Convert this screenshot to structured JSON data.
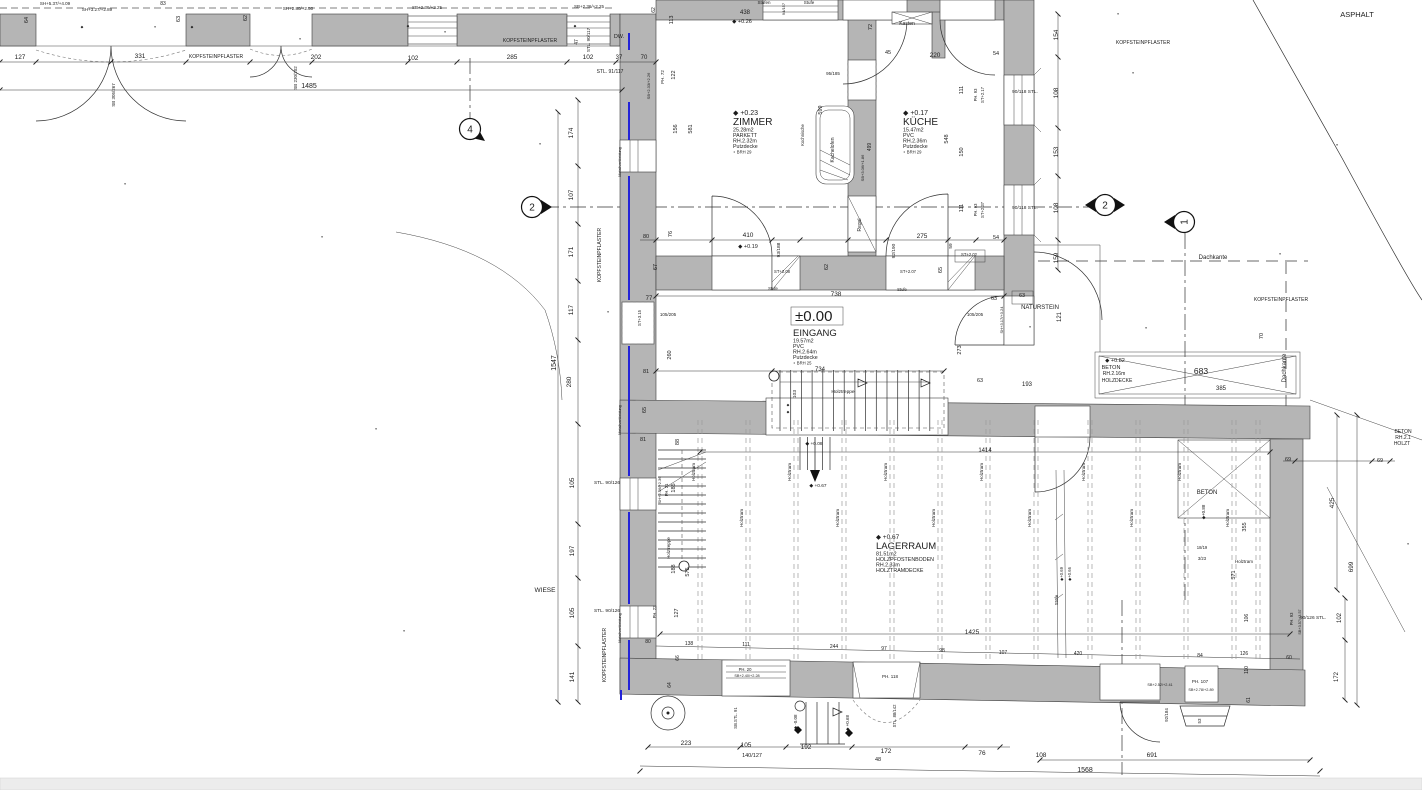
{
  "colors": {
    "wall_fill": "#b5b5b5",
    "line": "#2e2e2e",
    "cladding_blue": "#2323d8",
    "background": "#ffffff"
  },
  "rooms": {
    "zimmer": {
      "level": "◆ +0.23",
      "title": "ZIMMER",
      "l1": "25.28m2",
      "l2": "PARKETT",
      "l3": "RH.2.32m",
      "l4": "Putzdecke",
      "l5": "∘ BRH 29"
    },
    "kueche": {
      "level": "◆ +0.17",
      "title": "KÜCHE",
      "l1": "15.47m2",
      "l2": "PVC",
      "l3": "RH.2.36m",
      "l4": "Putzdecke",
      "l5": "∘ BRH 29"
    },
    "eingang": {
      "level": "±0.00",
      "title": "EINGANG",
      "l1": "19.57m2",
      "l2": "PVC",
      "l3": "RH.2.64m",
      "l4": "Putzdecke",
      "l5": "∘ BRH 25"
    },
    "lagerraum": {
      "level": "◆ +0.67",
      "title": "LAGERRAUM",
      "l1": "81.51m2",
      "l2": "HOLZPFOSTENBODEN",
      "l3": "RH.2.33m",
      "l4": "HOLZTRAMDECKE"
    }
  },
  "beams": {
    "label": "Holztram",
    "xs": [
      700,
      748,
      796,
      844,
      892,
      940,
      988,
      1036,
      1090,
      1138,
      1186,
      1234,
      1258
    ]
  },
  "markers": [
    {
      "n": "4",
      "x": 470,
      "y": 129,
      "rot": 0,
      "tri": "br"
    },
    {
      "n": "2",
      "x": 532,
      "y": 207,
      "rot": 0,
      "tri": "r"
    },
    {
      "n": "2",
      "x": 1105,
      "y": 205,
      "rot": 0,
      "tri": "lr"
    },
    {
      "n": "1",
      "x": 1184,
      "y": 222,
      "rot": -90,
      "tri": "l"
    }
  ],
  "labels": [
    [
      "ASPHALT",
      1357,
      17,
      0,
      7.5
    ],
    [
      "KOPFSTEINPFLASTER",
      1143,
      44,
      0,
      5
    ],
    [
      "KOPFSTEINPFLASTER",
      216,
      58,
      0,
      5
    ],
    [
      "KOPFSTEINPFLASTER",
      530,
      42,
      0,
      5
    ],
    [
      "KOPFSTEINPFLASTER",
      1281,
      301,
      0,
      5
    ],
    [
      "KOPFSTEINPFLASTER",
      601,
      255,
      -90,
      5
    ],
    [
      "KOPFSTEINPFLASTER",
      606,
      655,
      -90,
      5
    ],
    [
      "WIESE",
      545,
      592,
      0,
      6.5
    ],
    [
      "NATURSTEIN",
      1040,
      309,
      0,
      6
    ],
    [
      "Dachkante",
      1213,
      259,
      0,
      6
    ],
    [
      "Dachkante",
      1286,
      368,
      -90,
      6
    ],
    [
      "SH+5.37/+4.09",
      55,
      5,
      0,
      4.5
    ],
    [
      "83",
      163,
      5,
      0,
      5
    ],
    [
      "SH+3.27/+2.89",
      97,
      11,
      0,
      4.5
    ],
    [
      "SH+2.80/+2.50",
      298,
      10,
      0,
      4.5
    ],
    [
      "SB+2.36/+2.25",
      427,
      9,
      0,
      4.5
    ],
    [
      "SB+2.36/+2.25",
      589,
      8,
      0,
      4.5
    ],
    [
      "64",
      28,
      20,
      -90,
      5.5
    ],
    [
      "63",
      180,
      19,
      -90,
      5.5
    ],
    [
      "62",
      247,
      18,
      -90,
      5.5
    ],
    [
      "127",
      20,
      59,
      0,
      6.5
    ],
    [
      "331",
      140,
      58,
      0,
      6.5
    ],
    [
      "202",
      316,
      59,
      0,
      6.5
    ],
    [
      "102",
      413,
      60,
      0,
      6.5
    ],
    [
      "285",
      512,
      59,
      0,
      6.5
    ],
    [
      "102",
      588,
      59,
      0,
      6.5
    ],
    [
      "37",
      619,
      59,
      0,
      6
    ],
    [
      "70",
      644,
      59,
      0,
      6
    ],
    [
      "1485",
      309,
      88,
      0,
      7
    ],
    [
      "SB 305/267",
      115,
      95,
      -90,
      4.5
    ],
    [
      "SB 230/202",
      297,
      78,
      -90,
      4.5
    ],
    [
      "DW.",
      619,
      38,
      0,
      5.5
    ],
    [
      "STL. 90/117",
      590,
      40,
      -90,
      4.5
    ],
    [
      "47",
      578,
      42,
      -90,
      5
    ],
    [
      "STL. 91/117",
      610,
      73,
      0,
      5
    ],
    [
      "113",
      673,
      20,
      -90,
      5.5
    ],
    [
      "122",
      675,
      75,
      -90,
      5.5
    ],
    [
      "62",
      655,
      10,
      -90,
      5
    ],
    [
      "PH. 72",
      664,
      77,
      -90,
      4.5
    ],
    [
      "SB+2.33/+2.26",
      650,
      86,
      -90,
      4
    ],
    [
      "156",
      677,
      129,
      -90,
      5.5
    ],
    [
      "581",
      692,
      129,
      -90,
      5.5
    ],
    [
      "174",
      573,
      133,
      -90,
      6.5
    ],
    [
      "107",
      573,
      195,
      -90,
      6.5
    ],
    [
      "171",
      573,
      252,
      -90,
      6.5
    ],
    [
      "117",
      573,
      310,
      -90,
      6.5
    ],
    [
      "280",
      571,
      382,
      -90,
      6.5
    ],
    [
      "1547",
      556,
      363,
      -90,
      7
    ],
    [
      "105",
      574,
      483,
      -90,
      6.5
    ],
    [
      "197",
      574,
      551,
      -90,
      6.5
    ],
    [
      "105",
      574,
      613,
      -90,
      6.5
    ],
    [
      "141",
      574,
      677,
      -90,
      6.5
    ],
    [
      "Metallverkleidung",
      621,
      162,
      -90,
      3.8
    ],
    [
      "Metallverkleidung",
      621,
      420,
      -90,
      3.8
    ],
    [
      "Metallverkleidung",
      621,
      628,
      -90,
      3.8
    ],
    [
      "STL. 90/126",
      607,
      484,
      0,
      4.8
    ],
    [
      "STL. 90/126",
      607,
      612,
      0,
      4.8
    ],
    [
      "438",
      745,
      14,
      0,
      6
    ],
    [
      "◆ +0.26",
      742,
      23,
      0,
      5.5
    ],
    [
      "Stufen",
      764,
      4,
      0,
      4.5
    ],
    [
      "Stufe",
      809,
      4,
      0,
      4.5
    ],
    [
      "94/157",
      785,
      9,
      -90,
      4
    ],
    [
      "Kasten",
      907,
      25,
      0,
      5
    ],
    [
      "72",
      872,
      27,
      -90,
      5.5
    ],
    [
      "45",
      888,
      54,
      0,
      5.5
    ],
    [
      "220",
      935,
      57,
      0,
      6.5
    ],
    [
      "54",
      996,
      55,
      0,
      5.5
    ],
    [
      "95/185",
      833,
      75,
      0,
      4.5
    ],
    [
      "111",
      963,
      90,
      -90,
      5.5
    ],
    [
      "150",
      963,
      152,
      -90,
      5.5
    ],
    [
      "111",
      963,
      208,
      -90,
      5.5
    ],
    [
      "54",
      996,
      239,
      0,
      5.5
    ],
    [
      "548",
      948,
      139,
      -90,
      5.5
    ],
    [
      "599",
      822,
      110,
      -90,
      5.5
    ],
    [
      "499",
      871,
      147,
      -90,
      5
    ],
    [
      "SB+3.06/+1.86",
      864,
      168,
      -90,
      4
    ],
    [
      "Kochnische",
      804,
      135,
      -90,
      4.2
    ],
    [
      "Kachelofen",
      834,
      150,
      -90,
      5
    ],
    [
      "Regal",
      861,
      225,
      -90,
      5
    ],
    [
      "PH. 93",
      977,
      95,
      -90,
      4.2
    ],
    [
      "ST+2.17",
      984,
      95,
      -90,
      4.2
    ],
    [
      "90/118 STL.",
      1025,
      93,
      0,
      4.8
    ],
    [
      "PH. 93",
      977,
      210,
      -90,
      4.2
    ],
    [
      "ST+2.37",
      984,
      210,
      -90,
      4.2
    ],
    [
      "90/118 STL.",
      1025,
      209,
      0,
      4.8
    ],
    [
      "ST+2.02",
      969,
      256,
      0,
      4.2
    ],
    [
      "59",
      952,
      246,
      -90,
      4.8
    ],
    [
      "80",
      646,
      238,
      0,
      5.5
    ],
    [
      "76",
      672,
      234,
      -90,
      5.5
    ],
    [
      "410",
      748,
      237,
      0,
      6.5
    ],
    [
      "◆ +0.19",
      748,
      248,
      0,
      5.5
    ],
    [
      "93/188",
      780,
      250,
      -90,
      4.8
    ],
    [
      "62",
      828,
      267,
      -90,
      5.5
    ],
    [
      "275",
      922,
      238,
      0,
      6.5
    ],
    [
      "92/190",
      895,
      251,
      -90,
      4.8
    ],
    [
      "65",
      942,
      270,
      -90,
      5.5
    ],
    [
      "67",
      657,
      267,
      -90,
      5.5
    ],
    [
      "ST+2.08",
      782,
      273,
      0,
      4.2
    ],
    [
      "Stufe",
      773,
      290,
      0,
      4.2
    ],
    [
      "ST+2.07",
      908,
      273,
      0,
      4.2
    ],
    [
      "Stufe",
      902,
      291,
      0,
      4.2
    ],
    [
      "738",
      836,
      296,
      0,
      6.5
    ],
    [
      "77",
      649,
      300,
      0,
      6
    ],
    [
      "105/205",
      668,
      316,
      0,
      4.5
    ],
    [
      "ST+3.15",
      641,
      318,
      -90,
      4.2
    ],
    [
      "260",
      671,
      355,
      -90,
      5.5
    ],
    [
      "81",
      646,
      373,
      0,
      5.5
    ],
    [
      "65",
      646,
      410,
      -90,
      5.5
    ],
    [
      "105/205",
      975,
      316,
      0,
      4.5
    ],
    [
      "273",
      961,
      350,
      -90,
      5.5
    ],
    [
      "63",
      994,
      300,
      0,
      5.5
    ],
    [
      "63",
      980,
      382,
      0,
      5.5
    ],
    [
      "103",
      796,
      394,
      -90,
      4.8
    ],
    [
      "734",
      820,
      371,
      0,
      6
    ],
    [
      "Holztreppe",
      843,
      393,
      0,
      4.8
    ],
    [
      "SH+3.17/+3.24",
      1003,
      320,
      -90,
      4
    ],
    [
      "63",
      1022,
      297,
      0,
      5.5
    ],
    [
      "154",
      1058,
      35,
      -90,
      6.5
    ],
    [
      "108",
      1058,
      93,
      -90,
      6.5
    ],
    [
      "153",
      1058,
      152,
      -90,
      6.5
    ],
    [
      "108",
      1058,
      208,
      -90,
      6.5
    ],
    [
      "159",
      1058,
      258,
      -90,
      6.5
    ],
    [
      "121",
      1061,
      317,
      -90,
      6
    ],
    [
      "◆ +0.82",
      1115,
      362,
      0,
      5.5
    ],
    [
      "BETON",
      1111,
      369,
      0,
      5.5
    ],
    [
      "RH.2.16m",
      1114,
      375,
      0,
      5
    ],
    [
      "HOLZDECKE",
      1117,
      382,
      0,
      5
    ],
    [
      "683",
      1201,
      374,
      0,
      8.5
    ],
    [
      "193",
      1027,
      386,
      0,
      6
    ],
    [
      "385",
      1221,
      390,
      0,
      6
    ],
    [
      "70",
      1263,
      336,
      -90,
      5.5
    ],
    [
      "69",
      1288,
      461,
      0,
      5.5
    ],
    [
      "69",
      1380,
      462,
      0,
      5.5
    ],
    [
      "1414",
      985,
      452,
      0,
      6
    ],
    [
      "1425",
      972,
      634,
      0,
      6.5
    ],
    [
      "88",
      679,
      442,
      -90,
      5.5
    ],
    [
      "81",
      643,
      441,
      0,
      5.5
    ],
    [
      "SH+2.46/+2.36",
      661,
      490,
      -90,
      4
    ],
    [
      "PH. 21",
      668,
      490,
      -90,
      4.2
    ],
    [
      "185",
      675,
      488,
      -90,
      5.5
    ],
    [
      "188",
      675,
      569,
      -90,
      5.5
    ],
    [
      "575",
      689,
      572,
      -90,
      5.5
    ],
    [
      "Holztreppe",
      670,
      548,
      -90,
      4.5
    ],
    [
      "127",
      678,
      613,
      -90,
      5.5
    ],
    [
      "PH. 22",
      656,
      612,
      -90,
      4.2
    ],
    [
      "Stufe",
      1058,
      600,
      -90,
      4.5
    ],
    [
      "◆+0.69",
      1063,
      574,
      -90,
      4.2
    ],
    [
      "◆+0.66",
      1071,
      574,
      -90,
      4.2
    ],
    [
      "◆ +0.08",
      814,
      445,
      0,
      4.8
    ],
    [
      "◆ +0.67",
      818,
      487,
      0,
      4.8
    ],
    [
      "355",
      1246,
      527,
      -90,
      5.5
    ],
    [
      "425",
      1334,
      503,
      -90,
      6.5
    ],
    [
      "699",
      1353,
      567,
      -90,
      6.5
    ],
    [
      "571",
      1235,
      575,
      -90,
      5.5
    ],
    [
      "18/19",
      1202,
      549,
      0,
      4.2
    ],
    [
      "3/23",
      1202,
      560,
      0,
      4.2
    ],
    [
      "Holztram",
      1244,
      563,
      0,
      4.5
    ],
    [
      "◆+0.88",
      1205,
      512,
      -90,
      4.5
    ],
    [
      "BETON",
      1207,
      494,
      0,
      6
    ],
    [
      "BETON",
      1403,
      433,
      0,
      5
    ],
    [
      "RH.2.1",
      1403,
      439,
      0,
      5
    ],
    [
      "HOLZT",
      1402,
      445,
      0,
      5
    ],
    [
      "66",
      679,
      658,
      -90,
      5
    ],
    [
      "64",
      671,
      685,
      -90,
      5
    ],
    [
      "80",
      648,
      643,
      0,
      5
    ],
    [
      "138",
      689,
      645,
      0,
      5
    ],
    [
      "111",
      746,
      646,
      0,
      5
    ],
    [
      "244",
      834,
      648,
      0,
      5
    ],
    [
      "97",
      884,
      650,
      0,
      5
    ],
    [
      "98",
      942,
      652,
      0,
      5
    ],
    [
      "107",
      1003,
      654,
      0,
      5
    ],
    [
      "420",
      1078,
      655,
      0,
      5
    ],
    [
      "84",
      1200,
      657,
      0,
      5
    ],
    [
      "126",
      1244,
      655,
      0,
      5
    ],
    [
      "60",
      1289,
      659,
      0,
      5
    ],
    [
      "106",
      1248,
      618,
      -90,
      5
    ],
    [
      "110",
      1248,
      670,
      -90,
      5
    ],
    [
      "61",
      1250,
      700,
      -90,
      5
    ],
    [
      "PH. 20",
      745,
      671,
      0,
      4.2
    ],
    [
      "SB+2.40/+2.28",
      747,
      677,
      0,
      3.8
    ],
    [
      "SB.STL. 91",
      737,
      718,
      -90,
      4.2
    ],
    [
      "◆ -0.08",
      797,
      722,
      -90,
      4.5
    ],
    [
      "◆ +0.68",
      849,
      723,
      -90,
      4.5
    ],
    [
      "PH. 118",
      890,
      678,
      0,
      4.5
    ],
    [
      "STL. 88/142",
      896,
      716,
      -90,
      4.2
    ],
    [
      "SB+2.52/+2.41",
      1160,
      686,
      0,
      3.8
    ],
    [
      "92/184",
      1168,
      715,
      -90,
      4.5
    ],
    [
      "PH. 107",
      1200,
      683,
      0,
      4.5
    ],
    [
      "SB+2.78/+2.89",
      1201,
      691,
      0,
      3.8
    ],
    [
      "53",
      1201,
      721,
      -90,
      4.5
    ],
    [
      "90/126 STL.",
      1313,
      619,
      0,
      4.8
    ],
    [
      "102",
      1341,
      618,
      -90,
      6
    ],
    [
      "172",
      1338,
      677,
      -90,
      6
    ],
    [
      "PH. 93",
      1293,
      619,
      -90,
      4.2
    ],
    [
      "SB+3.57/+3.57",
      1301,
      622,
      -90,
      3.8
    ],
    [
      "223",
      686,
      745,
      0,
      6.5
    ],
    [
      "105",
      746,
      747,
      0,
      6.5
    ],
    [
      "140/127",
      752,
      757,
      0,
      5.5
    ],
    [
      "192",
      806,
      749,
      0,
      6.5
    ],
    [
      "172",
      886,
      753,
      0,
      6.5
    ],
    [
      "48",
      878,
      761,
      0,
      5.5
    ],
    [
      "76",
      982,
      755,
      0,
      6.5
    ],
    [
      "108",
      1041,
      757,
      0,
      6.5
    ],
    [
      "691",
      1152,
      757,
      0,
      6.5
    ],
    [
      "1568",
      1085,
      772,
      0,
      7
    ],
    [
      "∘",
      125,
      185,
      0,
      5
    ],
    [
      "∘",
      322,
      238,
      0,
      5
    ],
    [
      "∘",
      376,
      430,
      0,
      5
    ],
    [
      "∘",
      404,
      632,
      0,
      5
    ],
    [
      "∘",
      1118,
      15,
      0,
      5
    ],
    [
      "∘",
      1133,
      74,
      0,
      5
    ],
    [
      "∘",
      1030,
      328,
      0,
      5
    ],
    [
      "∘",
      1146,
      329,
      0,
      5
    ],
    [
      "∘",
      1280,
      255,
      0,
      5
    ],
    [
      "∘",
      1337,
      146,
      0,
      5
    ],
    [
      "∘",
      1408,
      545,
      0,
      5
    ],
    [
      "∘",
      608,
      313,
      0,
      5
    ],
    [
      "∘",
      155,
      28,
      0,
      5
    ],
    [
      "∘",
      300,
      40,
      0,
      5
    ],
    [
      "∘",
      445,
      33,
      0,
      5
    ],
    [
      "∘",
      540,
      145,
      0,
      5
    ],
    [
      "◆",
      82,
      28,
      0,
      3.5
    ],
    [
      "◆",
      192,
      28,
      0,
      3.5
    ],
    [
      "◆",
      408,
      27,
      0,
      3.5
    ],
    [
      "◆",
      575,
      27,
      0,
      3.5
    ],
    [
      "◆",
      788,
      406,
      0,
      3.5
    ],
    [
      "◆",
      788,
      413,
      0,
      3.5
    ]
  ]
}
